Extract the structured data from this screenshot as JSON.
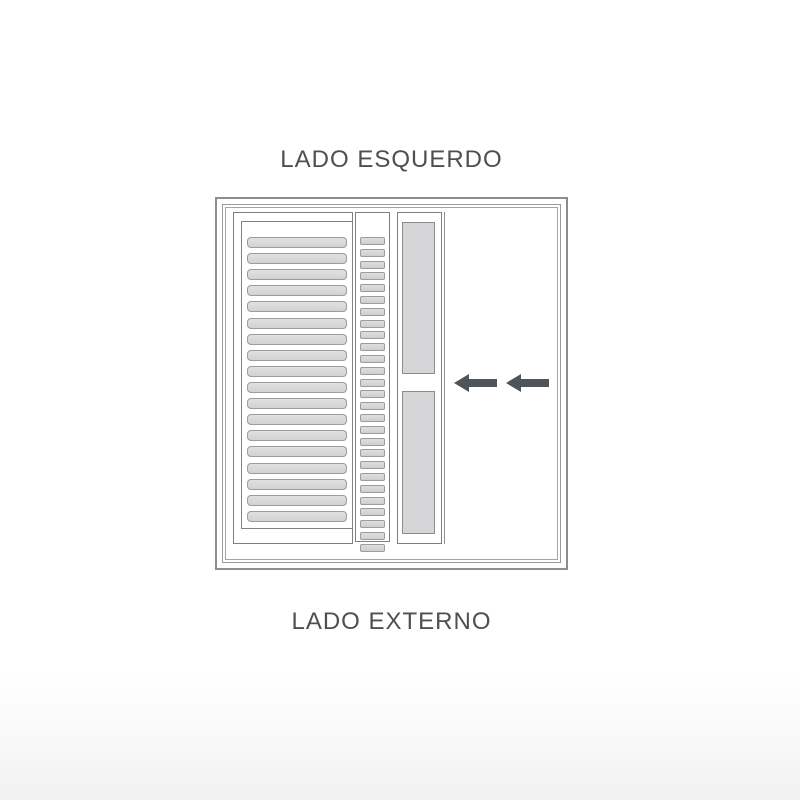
{
  "diagram": {
    "top_label": "LADO ESQUERDO",
    "bottom_label": "LADO EXTERNO",
    "type": "sliding-window-shutter-schematic",
    "arrows": {
      "direction": "left",
      "count": 2,
      "color": "#4e545a"
    },
    "panels": {
      "left_shutter": {
        "description": "wide louvered shutter panel",
        "slat_count": 18
      },
      "middle_shutter": {
        "description": "narrow louvered panel",
        "slat_count": 27
      },
      "glass_sash": {
        "description": "gray glass sliding sash with latch gap",
        "sections": 2
      },
      "opening": {
        "description": "open area"
      }
    },
    "colors": {
      "frame_line": "#8d8d8d",
      "slat_fill": "#d9d9d9",
      "slat_border": "#9c9c9c",
      "glass_fill": "#d5d5d7",
      "text": "#4f4f4f",
      "background": "#ffffff"
    }
  }
}
